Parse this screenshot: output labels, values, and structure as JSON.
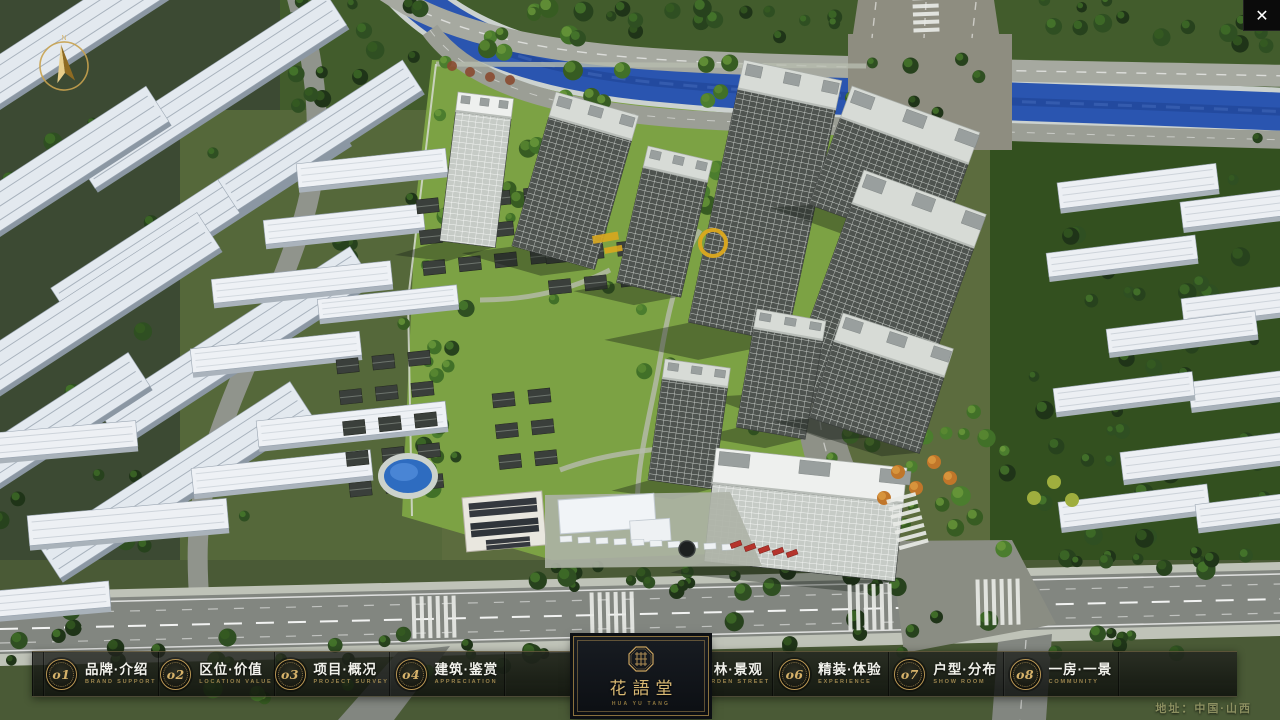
{
  "viewport": {
    "close_label": "✕"
  },
  "compass": {
    "cardinal": "N"
  },
  "navbar": {
    "items": [
      {
        "num": "o1",
        "zh": "品牌·介绍",
        "en": "BRAND SUPPORT"
      },
      {
        "num": "o2",
        "zh": "区位·价值",
        "en": "LOCATION VALUE"
      },
      {
        "num": "o3",
        "zh": "项目·概况",
        "en": "PROJECT SURVEY"
      },
      {
        "num": "o4",
        "zh": "建筑·鉴赏",
        "en": "APPRECIATION"
      },
      {
        "num": "o5",
        "zh": "园林·景观",
        "en": "GARDEN STREET"
      },
      {
        "num": "o6",
        "zh": "精装·体验",
        "en": "EXPERIENCE"
      },
      {
        "num": "o7",
        "zh": "户型·分布",
        "en": "SHOW ROOM"
      },
      {
        "num": "o8",
        "zh": "一房·一景",
        "en": "COMMUNITY"
      }
    ]
  },
  "logo": {
    "title": "花語堂",
    "subtitle": "HUA YU TANG"
  },
  "footer": {
    "address": "地址：中国·山西"
  },
  "scene": {
    "colors": {
      "river": "#2a55b0",
      "river_hi": "#5d86dd",
      "bank": "#ccd2cf",
      "lawn": "#7ca244",
      "forest": "#33501f",
      "road": "#828680",
      "road_light": "#a6a9a0",
      "plaza": "#8e8d80",
      "tower_facade": "#4e534f",
      "tower_roof": "#d7dbd6",
      "slab_roof": "#e3e9ef",
      "gold": "#c9a25e"
    }
  }
}
